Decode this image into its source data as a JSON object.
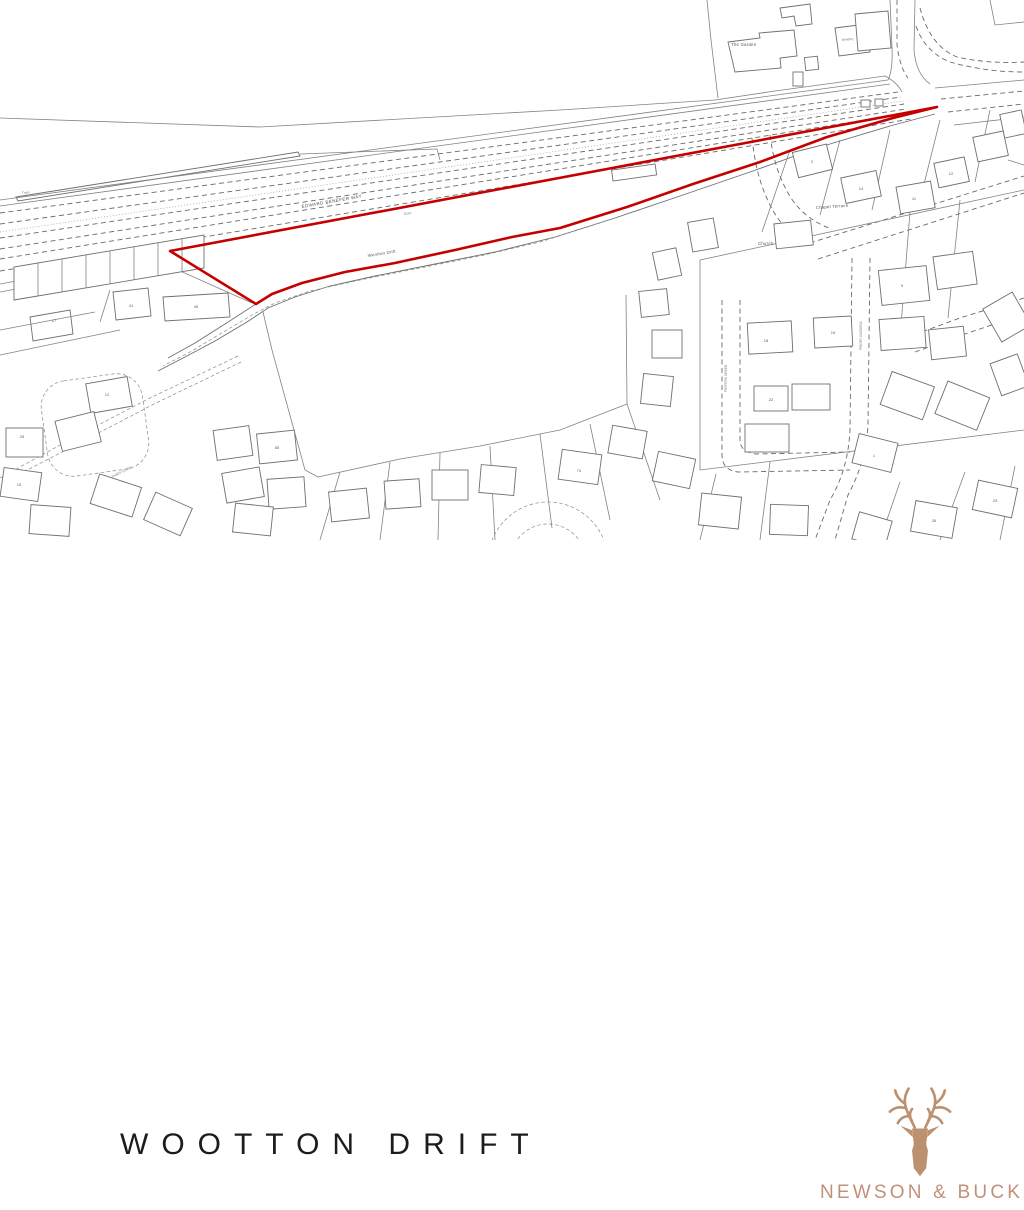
{
  "page": {
    "background": "#ffffff"
  },
  "map": {
    "site_boundary_color": "#c40000",
    "labels": {
      "main_road": "EDWARD BENEFER WAY",
      "site_road": "Wootton Drift",
      "chapel_terrace": "Chapel Terrace",
      "church": "Church",
      "the_garden": "The Garden",
      "house_name": "Brindley",
      "peppers_green": "PEPPERS GREEN",
      "priory_gardens": "PRIORY GARDENS",
      "james_close": "JAMES CLOSE",
      "track": "Track",
      "drain": "Drain"
    },
    "house_numbers": [
      {
        "n": "41",
        "x": 131,
        "y": 307
      },
      {
        "n": "49",
        "x": 196,
        "y": 308
      },
      {
        "n": "17",
        "x": 54,
        "y": 322
      },
      {
        "n": "25",
        "x": 22,
        "y": 438
      },
      {
        "n": "12",
        "x": 107,
        "y": 396
      },
      {
        "n": "15",
        "x": 19,
        "y": 486
      },
      {
        "n": "2",
        "x": 812,
        "y": 163
      },
      {
        "n": "14",
        "x": 861,
        "y": 190
      },
      {
        "n": "11",
        "x": 914,
        "y": 200
      },
      {
        "n": "12",
        "x": 951,
        "y": 175
      },
      {
        "n": "18",
        "x": 766,
        "y": 342
      },
      {
        "n": "15",
        "x": 833,
        "y": 334
      },
      {
        "n": "22",
        "x": 771,
        "y": 401
      },
      {
        "n": "1",
        "x": 874,
        "y": 457
      },
      {
        "n": "74",
        "x": 579,
        "y": 472
      },
      {
        "n": "85",
        "x": 277,
        "y": 449
      },
      {
        "n": "23",
        "x": 995,
        "y": 502
      },
      {
        "n": "26",
        "x": 934,
        "y": 522
      },
      {
        "n": "9",
        "x": 902,
        "y": 287
      }
    ]
  },
  "footer": {
    "title": "WOOTTON DRIFT",
    "brand": {
      "name": "NEWSON & BUCK",
      "color": "#c0917a",
      "icon": "stag-icon"
    }
  }
}
